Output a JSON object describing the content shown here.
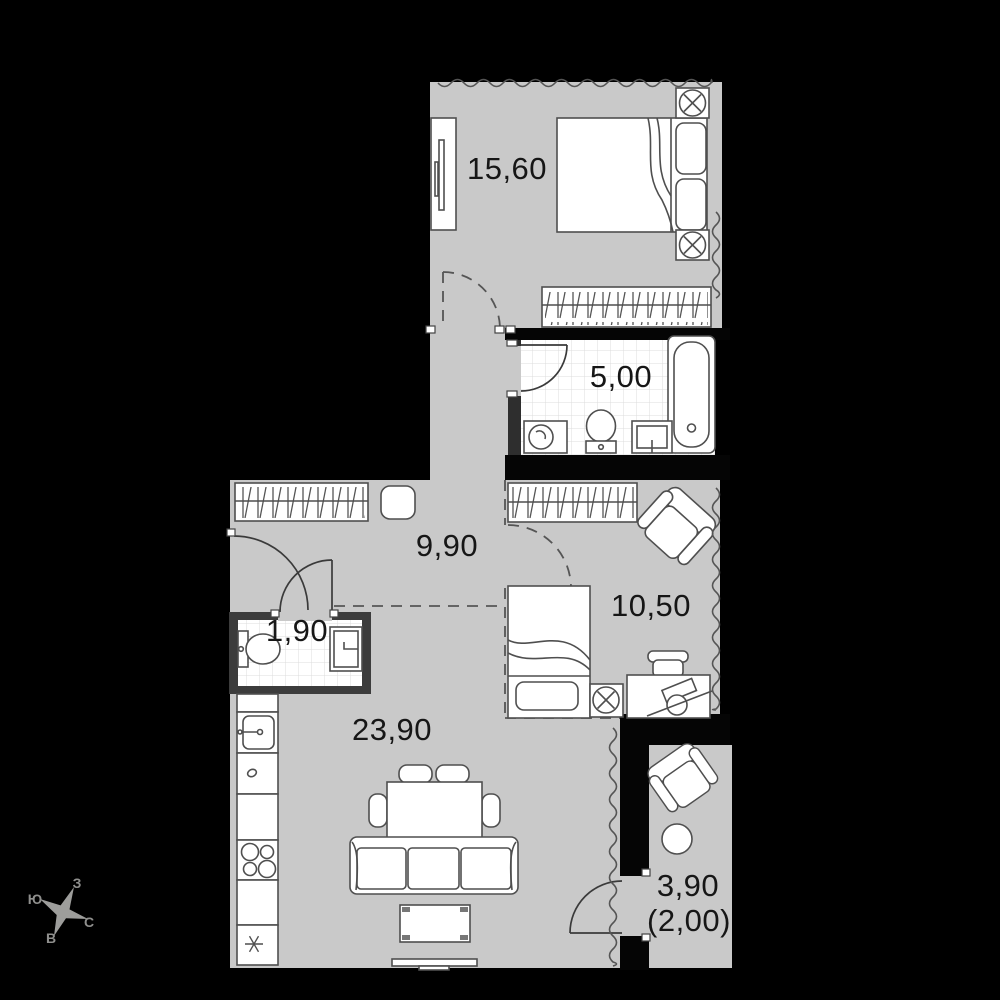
{
  "plan": {
    "rooms": [
      {
        "key": "bedroom",
        "area_label": "15,60"
      },
      {
        "key": "bathroom",
        "area_label": "5,00"
      },
      {
        "key": "hallway",
        "area_label": "9,90"
      },
      {
        "key": "bedroom-2",
        "area_label": "10,50"
      },
      {
        "key": "wc",
        "area_label": "1,90"
      },
      {
        "key": "kitchen-living",
        "area_label": "23,90"
      },
      {
        "key": "balcony",
        "area_label": "3,90",
        "area_label_secondary": "(2,00)"
      }
    ],
    "compass": {
      "top": "З",
      "left": "Ю",
      "right": "С",
      "bottom": "В"
    },
    "colors": {
      "background": "#000000",
      "floor": "#c9c9c9",
      "wet_wall": "#3c3c3c",
      "furniture_stroke": "#4f4f4f",
      "tile_grid": "#dcdcdc",
      "label": "#161616",
      "dashed_line": "#555555",
      "compass": "#9d9d9b"
    },
    "icons": [
      "double-bed",
      "single-bed",
      "nightstand-lamp",
      "wardrobe-hangers",
      "mirror-wardrobe",
      "bathtub",
      "toilet",
      "washbasin",
      "washing-machine",
      "kitchen-sink",
      "faucet",
      "stove-burners",
      "fridge-snowflake",
      "dining-table",
      "chair",
      "sofa",
      "coffee-table",
      "tv",
      "desk",
      "desk-chair",
      "armchair",
      "round-table",
      "pouf",
      "door-swing",
      "compass-rose"
    ]
  }
}
